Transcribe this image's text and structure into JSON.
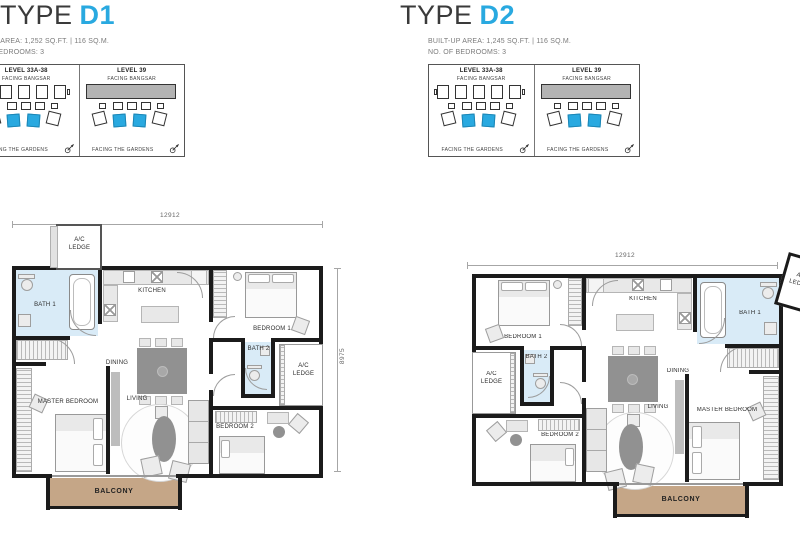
{
  "types": [
    {
      "title_prefix": "TYPE",
      "title_code": "D1",
      "area_line": "BUILT-UP AREA: 1,252 SQ.FT. | 116 SQ.M.",
      "bedrooms_line": "NO. OF BEDROOMS: 3",
      "dim_width": "12912",
      "dim_height": "8975"
    },
    {
      "title_prefix": "TYPE",
      "title_code": "D2",
      "area_line": "BUILT-UP AREA: 1,245 SQ.FT. | 116 SQ.M.",
      "bedrooms_line": "NO. OF BEDROOMS: 3",
      "dim_width": "12912"
    }
  ],
  "keyplan": {
    "panels": [
      {
        "level": "LEVEL 33A-38",
        "facing_top": "FACING BANGSAR",
        "facing_bottom": "FACING THE GARDENS"
      },
      {
        "level": "LEVEL 39",
        "facing_top": "FACING BANGSAR",
        "facing_bottom": "FACING THE GARDENS"
      }
    ]
  },
  "plan_rooms": {
    "bath1": "BATH 1",
    "kitchen": "KITCHEN",
    "bedroom1": "BEDROOM 1",
    "bath2": "BATH 2",
    "dining": "DINING",
    "living": "LIVING",
    "master_bedroom": "MASTER BEDROOM",
    "bedroom2": "BEDROOM 2",
    "balcony": "BALCONY",
    "ac_ledge": "A/C LEDGE"
  },
  "colors": {
    "accent_blue": "#29A9E0",
    "bath_fill": "#D9EBF7",
    "balcony_fill": "#C5A687",
    "wall": "#1B1B1B"
  }
}
